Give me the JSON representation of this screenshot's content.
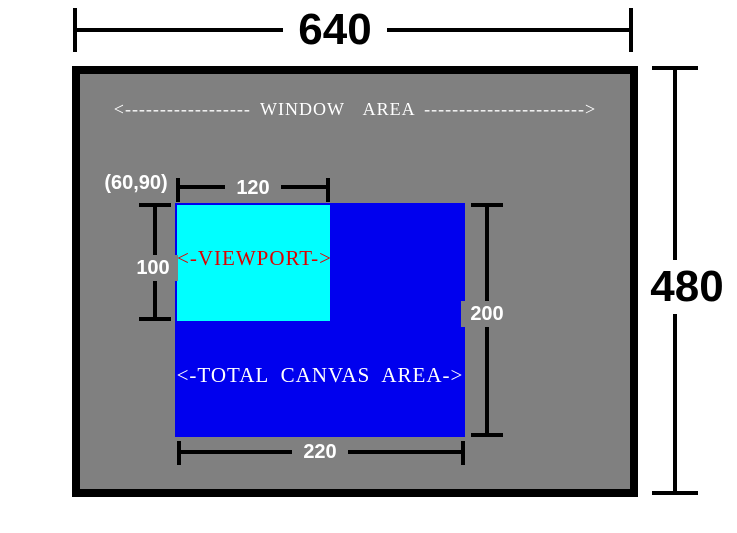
{
  "diagram": {
    "title_context": "window-canvas-viewport-diagram",
    "window": {
      "width_label": "640",
      "height_label": "480",
      "area_label": "<------------------ WINDOW  AREA ----------------------->"
    },
    "canvas": {
      "label": "<-TOTAL CANVAS AREA->",
      "width_label": "220",
      "height_label": "200",
      "origin_label": "(60,90)"
    },
    "viewport": {
      "label": "<-VIEWPORT->",
      "width_label": "120",
      "height_label": "100"
    },
    "colors": {
      "window_fill": "#808080",
      "window_border": "#000000",
      "canvas_fill": "#0000EE",
      "viewport_fill": "#00FFFF",
      "viewport_text": "#DD0000",
      "dimension_line": "#000000",
      "inner_label_text": "#FFFFFF",
      "outer_label_text": "#000000",
      "page_background": "#FFFFFF"
    }
  }
}
